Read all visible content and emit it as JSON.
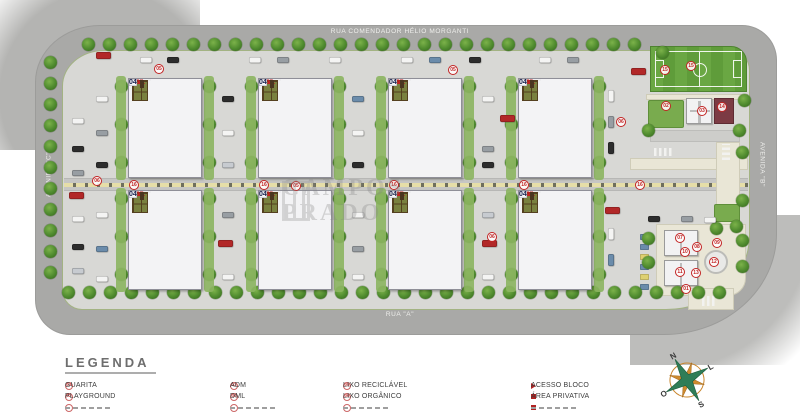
{
  "streets": {
    "top": "RUA COMENDADOR HÉLIO MORGANTI",
    "bottom": "RUA \"A\"",
    "left": "AVENIDA \"C\"",
    "right": "AVENIDA \"B\""
  },
  "watermark": {
    "text": "CAMPOS PRADO"
  },
  "site": {
    "block_prefix": "BL.",
    "strips": [
      {
        "row": 0,
        "col": 0,
        "top": "13",
        "bottom": "14"
      },
      {
        "row": 0,
        "col": 1,
        "top": "09",
        "bottom": "10"
      },
      {
        "row": 0,
        "col": 2,
        "top": "05",
        "bottom": "06"
      },
      {
        "row": 0,
        "col": 3,
        "top": "01",
        "bottom": "02"
      },
      {
        "row": 1,
        "col": 0,
        "top": "15",
        "bottom": "16"
      },
      {
        "row": 1,
        "col": 1,
        "top": "11",
        "bottom": "12"
      },
      {
        "row": 1,
        "col": 2,
        "top": "07",
        "bottom": "08"
      },
      {
        "row": 1,
        "col": 3,
        "top": "03",
        "bottom": "04"
      }
    ],
    "unit_left": [
      "04",
      "03",
      "01",
      "02"
    ],
    "unit_right": [
      "02",
      "01",
      "03",
      "04"
    ]
  },
  "legend": {
    "title": "LEGENDA",
    "items": [
      {
        "col": 0,
        "icon": "badge",
        "num": "01",
        "label": "GUARITA"
      },
      {
        "col": 0,
        "icon": "badge",
        "num": "02",
        "label": "PLAYGROUND"
      },
      {
        "col": 1,
        "icon": "badge",
        "num": "03",
        "label": "ADM"
      },
      {
        "col": 1,
        "icon": "badge",
        "num": "04",
        "label": "DML"
      },
      {
        "col": 2,
        "icon": "badge",
        "num": "05",
        "label": "LIXO RECICLÁVEL"
      },
      {
        "col": 2,
        "icon": "badge",
        "num": "06",
        "label": "LIXO ORGÂNICO"
      },
      {
        "col": 3,
        "icon": "triangle",
        "label": "ACESSO BLOCO"
      },
      {
        "col": 3,
        "icon": "square",
        "label": "ÁREA PRIVATIVA"
      }
    ]
  },
  "compass": {
    "north": "N",
    "east": "L",
    "south": "S",
    "west": "O"
  },
  "markers": [
    {
      "x": 159,
      "y": 69,
      "n": "05"
    },
    {
      "x": 453,
      "y": 70,
      "n": "05"
    },
    {
      "x": 97,
      "y": 181,
      "n": "06"
    },
    {
      "x": 296,
      "y": 186,
      "n": "05"
    },
    {
      "x": 492,
      "y": 237,
      "n": "06"
    },
    {
      "x": 621,
      "y": 122,
      "n": "06"
    },
    {
      "x": 134,
      "y": 185,
      "n": "16"
    },
    {
      "x": 264,
      "y": 185,
      "n": "16"
    },
    {
      "x": 394,
      "y": 185,
      "n": "16"
    },
    {
      "x": 524,
      "y": 185,
      "n": "16"
    },
    {
      "x": 640,
      "y": 185,
      "n": "16"
    },
    {
      "x": 665,
      "y": 70,
      "n": "15"
    },
    {
      "x": 691,
      "y": 66,
      "n": "15"
    },
    {
      "x": 666,
      "y": 106,
      "n": "02"
    },
    {
      "x": 702,
      "y": 111,
      "n": "03"
    },
    {
      "x": 722,
      "y": 107,
      "n": "14"
    },
    {
      "x": 680,
      "y": 238,
      "n": "07"
    },
    {
      "x": 697,
      "y": 247,
      "n": "08"
    },
    {
      "x": 717,
      "y": 243,
      "n": "09"
    },
    {
      "x": 685,
      "y": 252,
      "n": "10"
    },
    {
      "x": 680,
      "y": 272,
      "n": "11"
    },
    {
      "x": 696,
      "y": 273,
      "n": "13"
    },
    {
      "x": 714,
      "y": 262,
      "n": "12"
    },
    {
      "x": 686,
      "y": 289,
      "n": "01"
    }
  ],
  "cars": [
    [
      96,
      52,
      15,
      7,
      "R"
    ],
    [
      140,
      57,
      12,
      6,
      "W"
    ],
    [
      167,
      57,
      12,
      6,
      "K"
    ],
    [
      249,
      57,
      12,
      6,
      "W"
    ],
    [
      277,
      57,
      12,
      6,
      "G"
    ],
    [
      329,
      57,
      12,
      6,
      "W"
    ],
    [
      401,
      57,
      12,
      6,
      "W"
    ],
    [
      429,
      57,
      12,
      6,
      "B"
    ],
    [
      469,
      57,
      12,
      6,
      "K"
    ],
    [
      539,
      57,
      12,
      6,
      "W"
    ],
    [
      567,
      57,
      12,
      6,
      "G"
    ],
    [
      631,
      68,
      15,
      7,
      "R"
    ],
    [
      72,
      118,
      12,
      6,
      "W"
    ],
    [
      72,
      146,
      12,
      6,
      "K"
    ],
    [
      72,
      170,
      12,
      6,
      "G"
    ],
    [
      69,
      192,
      15,
      7,
      "R"
    ],
    [
      72,
      216,
      12,
      6,
      "W"
    ],
    [
      72,
      244,
      12,
      6,
      "K"
    ],
    [
      72,
      268,
      12,
      6,
      "S"
    ],
    [
      96,
      96,
      12,
      6,
      "W"
    ],
    [
      96,
      130,
      12,
      6,
      "G"
    ],
    [
      96,
      162,
      12,
      6,
      "K"
    ],
    [
      96,
      212,
      12,
      6,
      "W"
    ],
    [
      96,
      246,
      12,
      6,
      "B"
    ],
    [
      96,
      276,
      12,
      6,
      "W"
    ],
    [
      222,
      96,
      12,
      6,
      "K"
    ],
    [
      222,
      130,
      12,
      6,
      "W"
    ],
    [
      222,
      162,
      12,
      6,
      "S"
    ],
    [
      222,
      212,
      12,
      6,
      "G"
    ],
    [
      218,
      240,
      15,
      7,
      "R"
    ],
    [
      222,
      274,
      12,
      6,
      "W"
    ],
    [
      352,
      96,
      12,
      6,
      "B"
    ],
    [
      352,
      130,
      12,
      6,
      "W"
    ],
    [
      352,
      162,
      12,
      6,
      "K"
    ],
    [
      352,
      212,
      12,
      6,
      "W"
    ],
    [
      352,
      246,
      12,
      6,
      "G"
    ],
    [
      352,
      274,
      12,
      6,
      "W"
    ],
    [
      482,
      96,
      12,
      6,
      "W"
    ],
    [
      500,
      115,
      15,
      7,
      "R"
    ],
    [
      482,
      146,
      12,
      6,
      "G"
    ],
    [
      482,
      162,
      12,
      6,
      "K"
    ],
    [
      482,
      212,
      12,
      6,
      "S"
    ],
    [
      482,
      240,
      15,
      7,
      "R"
    ],
    [
      482,
      274,
      12,
      6,
      "W"
    ],
    [
      608,
      90,
      6,
      12,
      "W"
    ],
    [
      608,
      116,
      6,
      12,
      "G"
    ],
    [
      608,
      142,
      6,
      12,
      "K"
    ],
    [
      605,
      207,
      15,
      7,
      "R"
    ],
    [
      608,
      228,
      6,
      12,
      "W"
    ],
    [
      608,
      254,
      6,
      12,
      "B"
    ],
    [
      648,
      216,
      12,
      6,
      "K"
    ],
    [
      681,
      216,
      12,
      6,
      "G"
    ],
    [
      704,
      217,
      12,
      6,
      "W"
    ]
  ],
  "colors": {
    "accent_red": "#c22323",
    "street": "#a9a9a7",
    "site": "#d8d8d5",
    "building": "#f5f5f7",
    "tree_green": "#4e8a2e",
    "field_green": "#639f3c",
    "maroon": "#7c3b44",
    "unit_text": "#1c2550",
    "car_palette": {
      "W": "#f4f4f3",
      "K": "#2d2d2d",
      "G": "#989ea3",
      "B": "#6b8cab",
      "R": "#b22828",
      "S": "#c7cbd0",
      "Y": "#ddd071"
    }
  }
}
